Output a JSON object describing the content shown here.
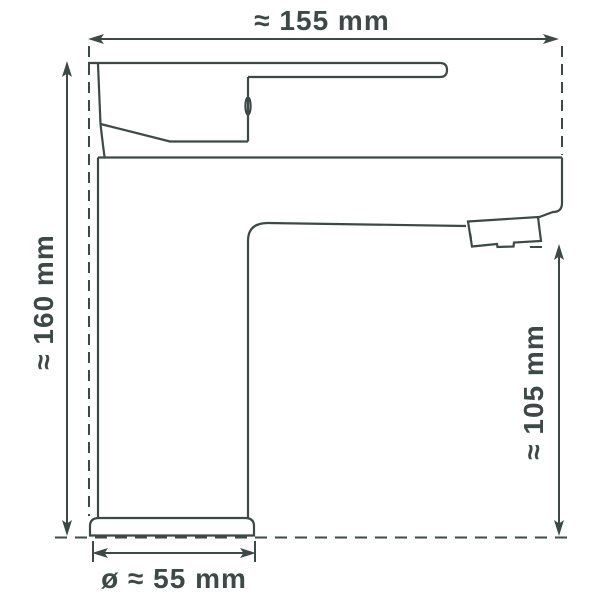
{
  "drawing": {
    "background_color": "#ffffff",
    "line_color": "#3c4946",
    "labels": {
      "width": "≈ 155 mm",
      "height": "≈ 160 mm",
      "spout_height": "≈ 105 mm",
      "base_diameter": "ø ≈ 55 mm"
    }
  }
}
